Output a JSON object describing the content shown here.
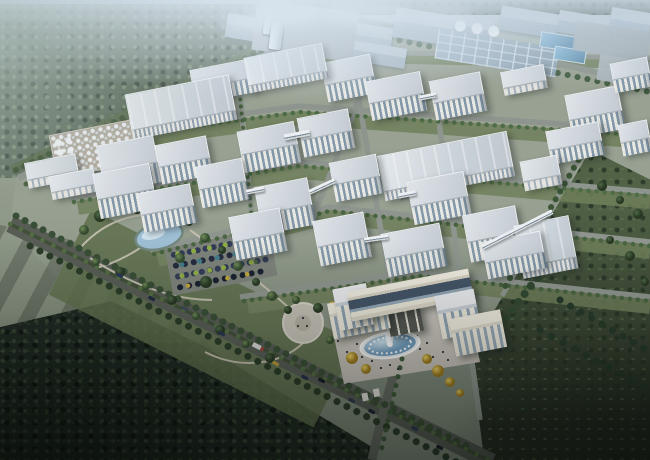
{
  "scene": {
    "description": "Aerial dusk rendering of a large industrial park campus: grid of white factory and office buildings, storage silos and tank farm, landscaped park with pond and parking lot, main gate building with fountain plaza, surrounded by dense forest and fields",
    "type": "architectural-rendering",
    "time_of_day": "dusk"
  },
  "palette": {
    "hazeTop": "#c7d5e2",
    "forestFar": "#74836f",
    "forestMid": "#4d5c49",
    "forestDeep": "#18221a",
    "meadow": "#49593b",
    "campusGround": "#97a08f",
    "roadLight": "#8e948c",
    "roadMain": "#53584f",
    "roofHi": "#e4e8ec",
    "roofMid": "#c6cdd4",
    "face": "#edece7",
    "windowBand": "#8298a8",
    "glass": "#3f5062",
    "gateWall": "#efe9da",
    "pondWater": "#9fc0d6",
    "fountainWater": "#8fb4d4",
    "plaza": "#c8c3b9",
    "treeGreen": "#44603a",
    "treeYellow": "#d9ab2b",
    "carNavy": "#243051",
    "carRed": "#a33a30",
    "distantBlue": "#a9bac7",
    "tankPad": "#b3ac9e",
    "siloWhite": "#dfe6ec",
    "steamWhite": "#eef4f8"
  },
  "inventory": {
    "silo_count": 12,
    "large_warehouses": 5,
    "office_buildings": 24,
    "parking_rows": 4,
    "fountains": 1,
    "ponds": 1,
    "gate_buildings": 1
  }
}
